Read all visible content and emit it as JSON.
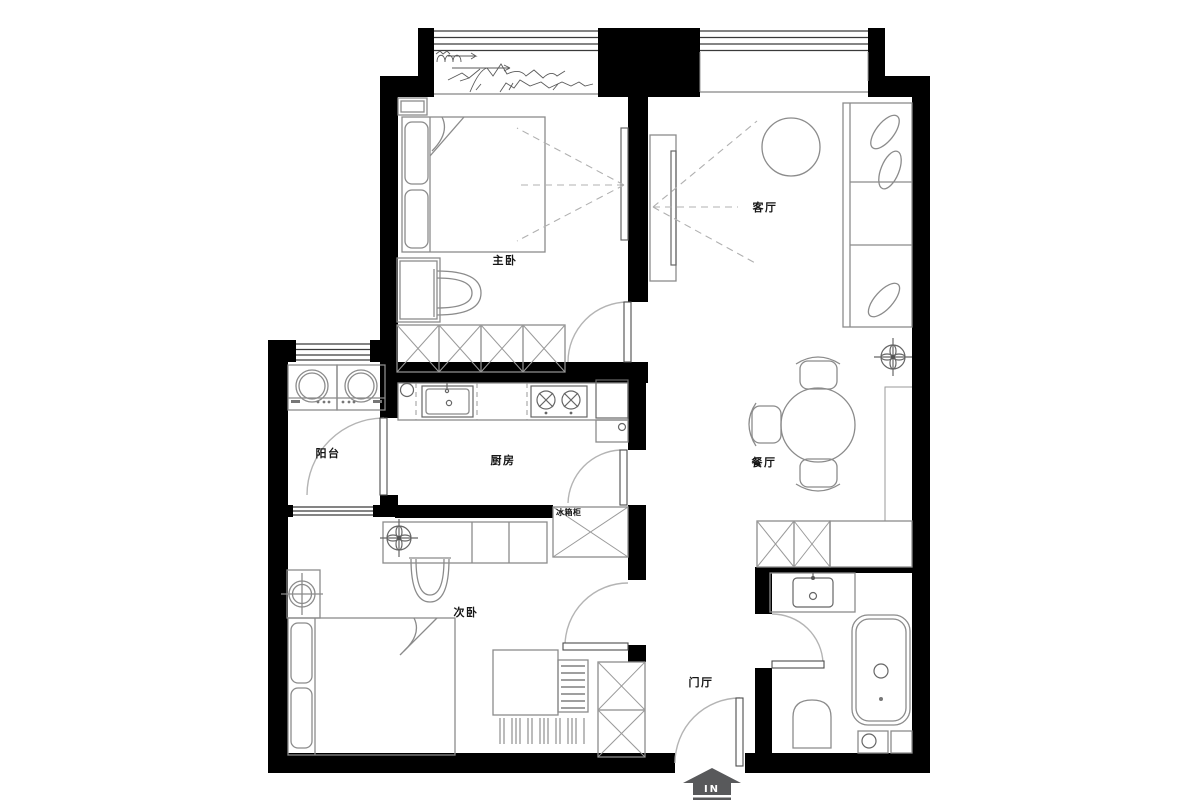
{
  "title": "apartment-floor-plan",
  "colors": {
    "wall": "#000000",
    "furniture_line": "#8b8b8b",
    "door_arc": "#b4b4b4",
    "label_text": "#151515",
    "entry_arrow": "#58595b",
    "sightline": "#b0b0b0"
  },
  "rooms": {
    "master_bedroom": {
      "label": "主卧"
    },
    "living_room": {
      "label": "客厅"
    },
    "balcony": {
      "label": "阳台"
    },
    "kitchen": {
      "label": "厨房"
    },
    "fridge_cabinet": {
      "label": "冰箱柜"
    },
    "dining_room": {
      "label": "餐厅"
    },
    "second_bedroom": {
      "label": "次卧"
    },
    "entrance_hall": {
      "label": "门厅"
    }
  },
  "entry": {
    "label": "IN"
  },
  "fixtures": [
    "double-bed",
    "nightstand",
    "dressing-table",
    "chair",
    "wardrobe",
    "wall-tv",
    "sofa",
    "pillows",
    "round-chair",
    "tv-console",
    "ceiling-lamp",
    "washing-machine",
    "washing-machine",
    "kitchen-sink",
    "two-burner-cooktop",
    "refrigerator",
    "floor-drain",
    "dining-table",
    "dining-chairs",
    "storage-cabinet",
    "single-bed",
    "desk",
    "drawer-unit",
    "floor-mat",
    "bathroom-sink",
    "bathtub",
    "toilet",
    "washer",
    "entry-door"
  ]
}
